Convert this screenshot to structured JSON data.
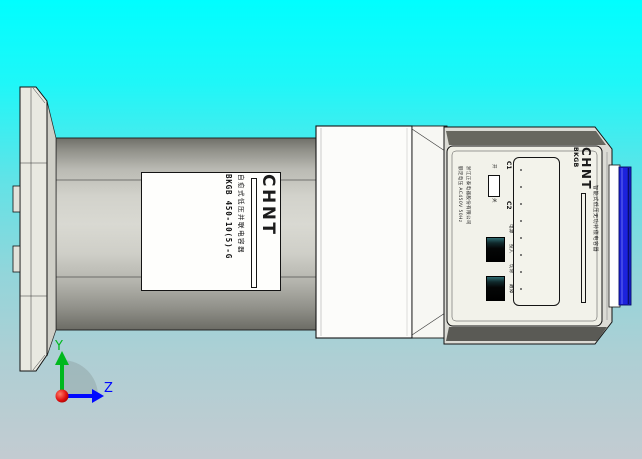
{
  "viewer": {
    "description": "3D CAD preview of a CHINT cylindrical intelligent capacitor, side view",
    "colors": {
      "background_top": "#00feff",
      "background_bottom": "#c3cbd1",
      "cylinder_gray": "#d9d9d2",
      "panel_cream": "#efefe6",
      "terminal_blue": "#1c22dd",
      "axis_y_green": "#00b81e",
      "axis_z_blue": "#0008ff",
      "origin_red": "#d80000"
    }
  },
  "axis": {
    "y": "Y",
    "z": "Z"
  },
  "cylinder_label": {
    "brand": "CHNT",
    "product": "自愈式低压并联电容器",
    "model": "BKGB 450-10(5)-G"
  },
  "panel": {
    "brand": "CHNT",
    "series": "BKGB",
    "subtitle": "智能式低压无功补偿电容器",
    "maker_line1": "浙江正泰电器股份有限公司",
    "maker_line2": "额定电压 AC450V 50Hz",
    "c1": "C1",
    "c2": "C2",
    "indicators": [
      "电源",
      "投入",
      "切除",
      "故障"
    ],
    "switch_top": "开",
    "switch_bottom": "关"
  }
}
